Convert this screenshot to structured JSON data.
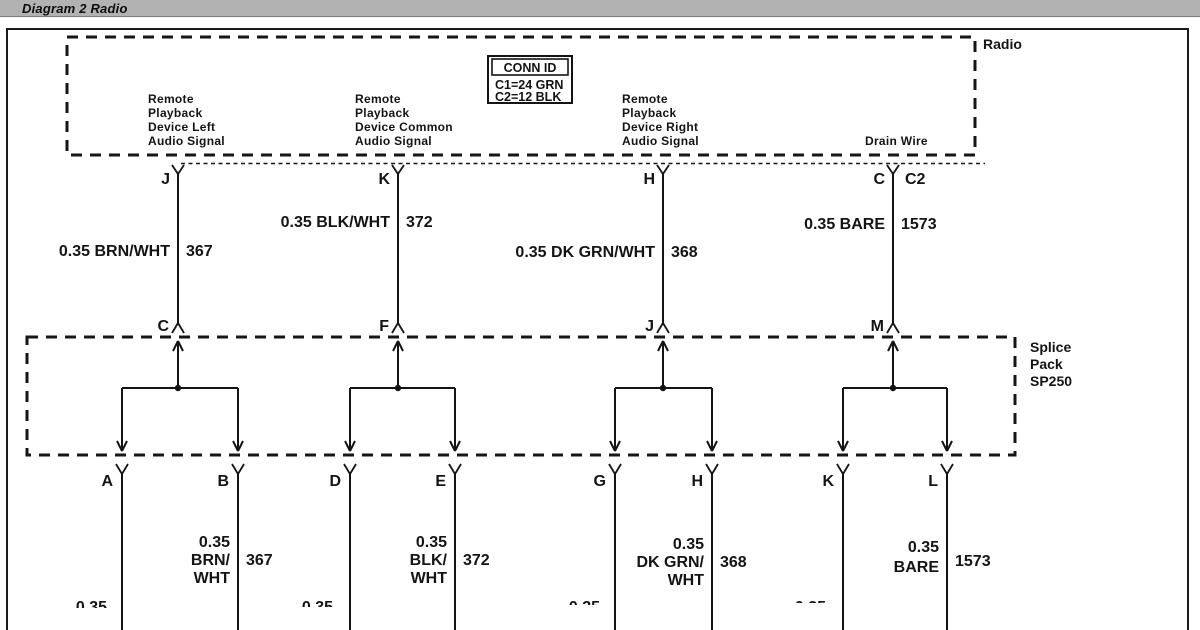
{
  "window": {
    "title": "Diagram 2 Radio"
  },
  "radio": {
    "box_label": "Radio",
    "connector_label": "C2",
    "conn_id": {
      "header": "CONN ID",
      "rows": [
        "C1=24 GRN",
        "C2=12 BLK"
      ]
    },
    "pins": [
      {
        "letter": "J",
        "signal_lines": [
          "Remote",
          "Playback",
          "Device Left",
          "Audio Signal"
        ],
        "wire": {
          "label": "0.35 BRN/WHT",
          "circuit": "367"
        }
      },
      {
        "letter": "K",
        "signal_lines": [
          "Remote",
          "Playback",
          "Device Common",
          "Audio Signal"
        ],
        "wire": {
          "label": "0.35 BLK/WHT",
          "circuit": "372"
        }
      },
      {
        "letter": "H",
        "signal_lines": [
          "Remote",
          "Playback",
          "Device Right",
          "Audio Signal"
        ],
        "wire": {
          "label": "0.35 DK GRN/WHT",
          "circuit": "368"
        }
      },
      {
        "letter": "C",
        "signal_lines": [
          "Drain Wire"
        ],
        "wire": {
          "label": "0.35 BARE",
          "circuit": "1573"
        }
      }
    ]
  },
  "splice_pack": {
    "box_label_lines": [
      "Splice",
      "Pack",
      "SP250"
    ],
    "top_pins": [
      "C",
      "F",
      "J",
      "M"
    ],
    "bottom_pins": [
      [
        "A",
        "B"
      ],
      [
        "D",
        "E"
      ],
      [
        "G",
        "H"
      ],
      [
        "K",
        "L"
      ]
    ],
    "bottom_wires": [
      {
        "label_lines": [
          "0.35",
          "BRN/",
          "WHT"
        ],
        "circuit": "367",
        "partial_label": "0.35"
      },
      {
        "label_lines": [
          "0.35",
          "BLK/",
          "WHT"
        ],
        "circuit": "372",
        "partial_label": "0.35"
      },
      {
        "label_lines": [
          "0.35",
          "DK GRN/",
          "WHT"
        ],
        "circuit": "368",
        "partial_label": "0.35"
      },
      {
        "label_lines": [
          "0.35",
          "BARE"
        ],
        "circuit": "1573",
        "partial_label": "0.35"
      }
    ]
  }
}
